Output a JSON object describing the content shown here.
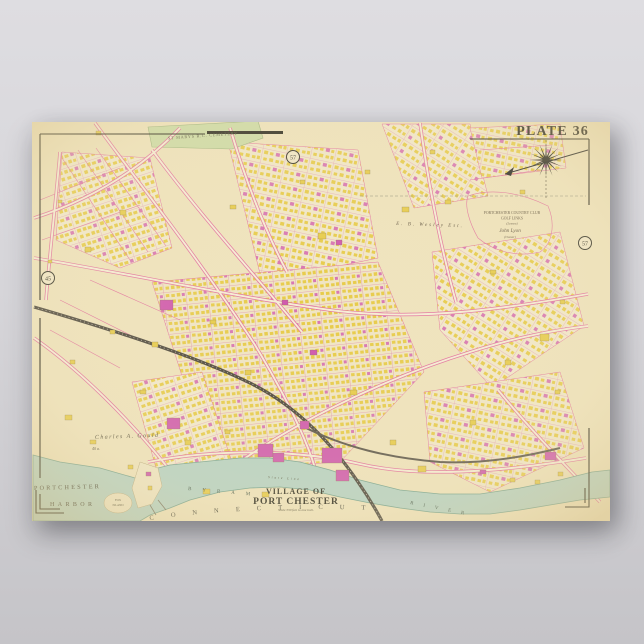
{
  "poster": {
    "plate_label": "PLATE 36",
    "paper_color": "#efe3bd"
  },
  "map": {
    "title": {
      "line1": "VILLAGE OF",
      "line2": "PORT CHESTER",
      "scale_note": "Scale 330 feet to one inch."
    },
    "labels": {
      "harbor_line1": "PORTCHESTER",
      "harbor_line2": "HARBOR",
      "state_name": "CONNECTICUT",
      "river_word1": "BYRAM",
      "river_word2": "RIVER",
      "state_line": "State Line",
      "cemetery": "ST MARYS R.C. CEMETERY",
      "country_club_line1": "PORTCHESTER COUNTRY CLUB",
      "country_club_line2": "GOLF LINKS",
      "country_club_line3": "(Lessee)",
      "country_club_line4": "John Lyon",
      "country_club_line5": "(Owner)",
      "wesley_estate": "E. B. Wesley Est.",
      "gould_estate": "Charles A. Gould",
      "gould_acreage": "40 a.",
      "island_line1": "FOX",
      "island_line2": "ISLAND"
    },
    "plate_markers": {
      "left": "45",
      "top": "57",
      "right": "57"
    },
    "colors": {
      "paper": "#efe3bd",
      "water": "#b5d2c5",
      "water_edge": "#74a290",
      "street_pink": "#e2719f",
      "building_wood_yellow": "#e7cb49",
      "building_brick_magenta": "#cf56ae",
      "railroad_dark": "#4a453c",
      "park_green": "#ccdba6",
      "frame_ink": "#26251d"
    }
  }
}
